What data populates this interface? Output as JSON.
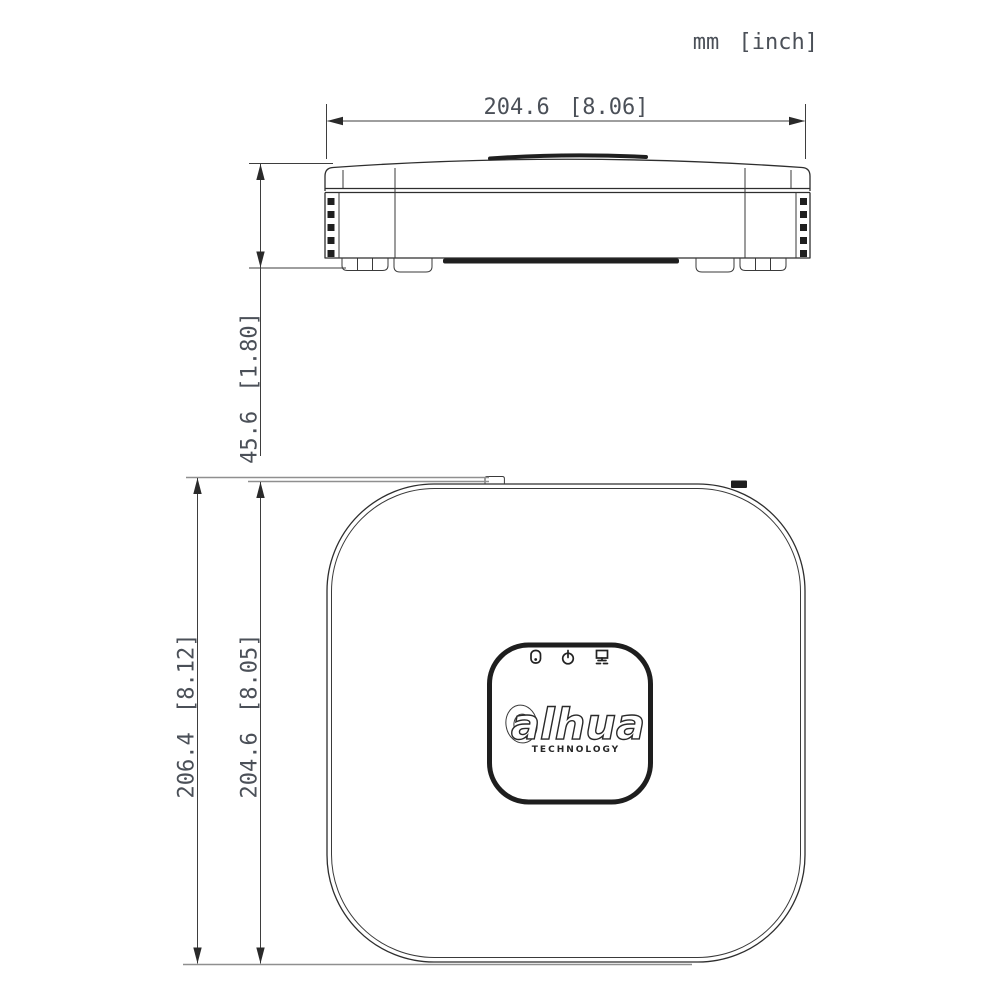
{
  "units_label": "mm [inch]",
  "front_view": {
    "width_dim": "204.6 [8.06]",
    "height_dim": "45.6 [1.80]"
  },
  "top_view": {
    "overall_depth_dim": "206.4 [8.12]",
    "body_depth_dim": "204.6 [8.05]",
    "logo_text": "alhua",
    "logo_tagline": "TECHNOLOGY",
    "led_icons": [
      "hdd-led-icon",
      "power-led-icon",
      "network-led-icon"
    ]
  },
  "colors": {
    "background": "#ffffff",
    "outline": "#2e2e2e",
    "dimension_line": "#3e3e3e",
    "extension_gray": "#8f8f8f",
    "dimension_text": "#4b5058",
    "dark_fill": "#1f1f1f"
  }
}
